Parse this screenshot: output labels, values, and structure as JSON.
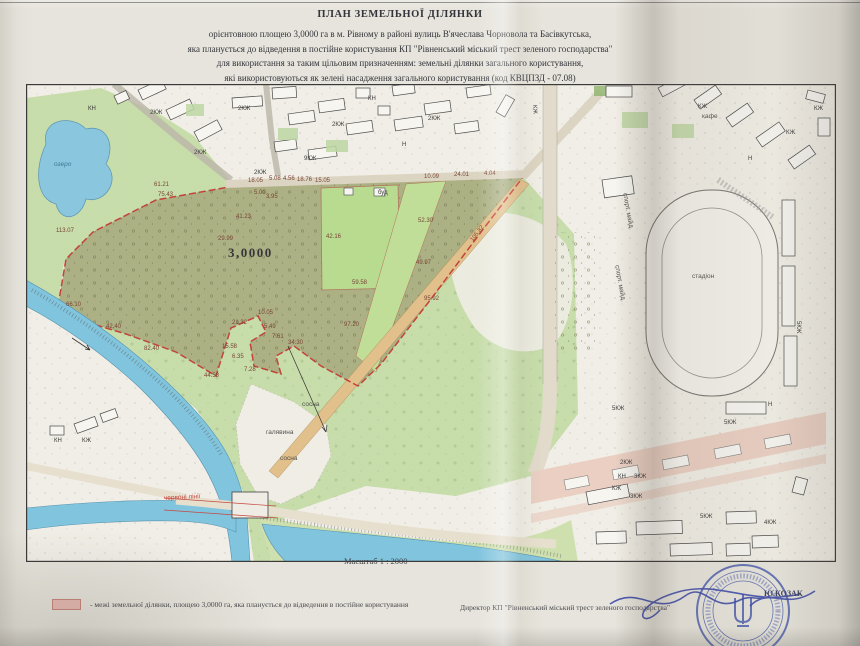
{
  "header": {
    "title": "ПЛАН ЗЕМЕЛЬНОЇ ДІЛЯНКИ",
    "line1": "орієнтовною площею 3,0000 га в м. Рівному в районі вулиць В'ячеслава Чорновола та Басівкутська,",
    "line2": "яка планується до відведення в постійне користування КП \"Рівненський міський трест зеленого господарства\"",
    "line3": "для використання за таким цільовим призначенням: земельні ділянки загального користування,",
    "line4": "які використовуються як зелені насадження загального користування (код КВЦПЗД - 07.08)"
  },
  "map": {
    "scale_label": "Масштаб 1 : 2000",
    "place_labels": [
      {
        "t": "озеро",
        "x": 28,
        "y": 78,
        "cls": "pl-water"
      },
      {
        "t": "3,0000",
        "x": 202,
        "y": 162,
        "cls": "pl-area"
      },
      {
        "t": "галявина",
        "x": 240,
        "y": 346,
        "cls": ""
      },
      {
        "t": "сосна",
        "x": 276,
        "y": 318,
        "cls": ""
      },
      {
        "t": "сосна",
        "x": 254,
        "y": 372,
        "cls": ""
      },
      {
        "t": "червоні лінії",
        "x": 138,
        "y": 412,
        "cls": "pl-red",
        "rot": -3
      },
      {
        "t": "стадіон",
        "x": 666,
        "y": 190,
        "cls": ""
      },
      {
        "t": "спорт. майд.",
        "x": 598,
        "y": 106,
        "cls": "",
        "rot": 80
      },
      {
        "t": "спорт. майд.",
        "x": 590,
        "y": 178,
        "cls": "",
        "rot": 80
      },
      {
        "t": "кафе",
        "x": 676,
        "y": 30,
        "cls": ""
      }
    ],
    "building_labels": [
      {
        "t": "КН",
        "x": 62,
        "y": 22
      },
      {
        "t": "2КЖ",
        "x": 124,
        "y": 26
      },
      {
        "t": "2КЖ",
        "x": 212,
        "y": 22
      },
      {
        "t": "2КЖ",
        "x": 168,
        "y": 66
      },
      {
        "t": "2КЖ",
        "x": 228,
        "y": 86
      },
      {
        "t": "9КЖ",
        "x": 278,
        "y": 72
      },
      {
        "t": "2КЖ",
        "x": 306,
        "y": 38
      },
      {
        "t": "КН",
        "x": 342,
        "y": 12
      },
      {
        "t": "Н",
        "x": 376,
        "y": 58
      },
      {
        "t": "2КЖ",
        "x": 402,
        "y": 32
      },
      {
        "t": "буд",
        "x": 352,
        "y": 106
      },
      {
        "t": "КЖ",
        "x": 672,
        "y": 20
      },
      {
        "t": "КЖ",
        "x": 788,
        "y": 22
      },
      {
        "t": "КЖ",
        "x": 760,
        "y": 46
      },
      {
        "t": "Н",
        "x": 722,
        "y": 72
      },
      {
        "t": "КЖ",
        "x": 508,
        "y": 18,
        "rot": 85
      },
      {
        "t": "5КЖ",
        "x": 586,
        "y": 322
      },
      {
        "t": "5КЖ",
        "x": 698,
        "y": 336
      },
      {
        "t": "5КЖ",
        "x": 674,
        "y": 430
      },
      {
        "t": "5КЖ",
        "x": 772,
        "y": 234,
        "rot": 90
      },
      {
        "t": "2КЖ",
        "x": 594,
        "y": 376
      },
      {
        "t": "КН",
        "x": 592,
        "y": 390
      },
      {
        "t": "3КЖ",
        "x": 608,
        "y": 390
      },
      {
        "t": "КЖ",
        "x": 586,
        "y": 402
      },
      {
        "t": "3КЖ",
        "x": 604,
        "y": 410
      },
      {
        "t": "4КЖ",
        "x": 738,
        "y": 436
      },
      {
        "t": "Н",
        "x": 742,
        "y": 318
      },
      {
        "t": "КЖ",
        "x": 56,
        "y": 354
      },
      {
        "t": "КН",
        "x": 28,
        "y": 354
      }
    ],
    "measurements": [
      {
        "t": "113.07",
        "x": 30,
        "y": 144
      },
      {
        "t": "61.21",
        "x": 128,
        "y": 98
      },
      {
        "t": "75.43",
        "x": 132,
        "y": 108
      },
      {
        "t": "29.99",
        "x": 192,
        "y": 152
      },
      {
        "t": "41.23",
        "x": 210,
        "y": 130
      },
      {
        "t": "18.05",
        "x": 222,
        "y": 94
      },
      {
        "t": "5.08",
        "x": 243,
        "y": 92
      },
      {
        "t": "4.56",
        "x": 257,
        "y": 92
      },
      {
        "t": "18.76",
        "x": 271,
        "y": 93
      },
      {
        "t": "15.05",
        "x": 289,
        "y": 94
      },
      {
        "t": "5.00",
        "x": 228,
        "y": 106
      },
      {
        "t": "3.95",
        "x": 240,
        "y": 110
      },
      {
        "t": "10.09",
        "x": 398,
        "y": 90
      },
      {
        "t": "24.01",
        "x": 428,
        "y": 88
      },
      {
        "t": "4.04",
        "x": 458,
        "y": 87
      },
      {
        "t": "42.16",
        "x": 300,
        "y": 150
      },
      {
        "t": "52.30",
        "x": 392,
        "y": 134
      },
      {
        "t": "105.82",
        "x": 446,
        "y": 154,
        "rot": -52
      },
      {
        "t": "49.97",
        "x": 390,
        "y": 176
      },
      {
        "t": "59.58",
        "x": 326,
        "y": 196
      },
      {
        "t": "95.92",
        "x": 398,
        "y": 212
      },
      {
        "t": "97.20",
        "x": 318,
        "y": 238
      },
      {
        "t": "34.30",
        "x": 262,
        "y": 256
      },
      {
        "t": "10.05",
        "x": 232,
        "y": 226
      },
      {
        "t": "21.32",
        "x": 206,
        "y": 236
      },
      {
        "t": "5.49",
        "x": 238,
        "y": 240
      },
      {
        "t": "7.61",
        "x": 246,
        "y": 250
      },
      {
        "t": "15.58",
        "x": 196,
        "y": 260
      },
      {
        "t": "6.35",
        "x": 206,
        "y": 270
      },
      {
        "t": "7.28",
        "x": 218,
        "y": 283
      },
      {
        "t": "44.58",
        "x": 178,
        "y": 289
      },
      {
        "t": "82.40",
        "x": 118,
        "y": 262
      },
      {
        "t": "42.40",
        "x": 80,
        "y": 240
      },
      {
        "t": "66.10",
        "x": 40,
        "y": 218
      }
    ]
  },
  "legend": {
    "text": "- межі земельної ділянки, площею 3,0000 га, яка планується до  відведення  в постійне користування"
  },
  "footer": {
    "director_label": "Директор КП \"Рівненський міський трест зеленого господарства\"",
    "signer": "Ю.КОЗАК"
  },
  "colors": {
    "parcel_boundary_red": "#c2342c",
    "parcel_olive": "#a8ae7d",
    "lawn_green": "#b5dd8b",
    "park_green": "#c6dfa8",
    "water_blue": "#78c4e1",
    "street_pink": "#edd0c3",
    "path_tan": "#e3bf85",
    "stamp_blue": "#3d53ad",
    "legend_pink": "#eab9b2"
  }
}
